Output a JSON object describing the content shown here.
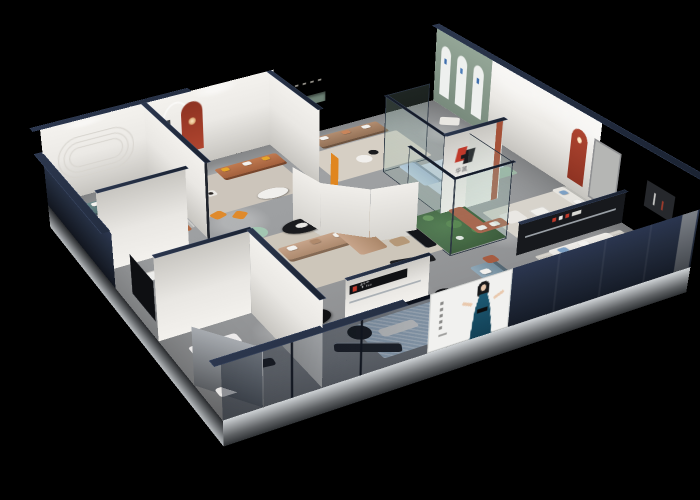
{
  "scene": {
    "description": "3D isometric cutaway render of a furniture showroom at night on a black background",
    "background": "#000000",
    "brand": {
      "logo_letter": "H",
      "logo_characters": "华凯",
      "logo_red": "#c0392b",
      "logo_black": "#1b1b1f"
    },
    "poster": {
      "background": "#f1f1ef",
      "subject": "woman in teal evening dress",
      "dress_color": "#175066",
      "hair_color": "#17181a"
    },
    "palette": {
      "floor": "#9a9c9e",
      "wall_interior": "#efedea",
      "wall_cap_navy": "#1f2838",
      "facade_navy": "#1b2230",
      "skirt_silver": "#cfd3d6",
      "accent_red_arch": "#a33b27",
      "accent_red_shelf": "#b23527",
      "accent_orange": "#e08a2c",
      "accent_teal_sofa": "#5d7d7f",
      "accent_caramel_sofa": "#b06a45",
      "accent_tan_sectional": "#bd9b82",
      "accent_light_blue_sofa": "#aec3da",
      "accent_sage_sofa": "#9cb6a4",
      "accent_blue_gray_sofa": "#8099a9",
      "accent_mint_ottoman": "#a3c6b2",
      "cream_sofa": "#e8e6e1",
      "green_arch_wall": "#8c9e8f",
      "garden_green": "#3a5c37",
      "glass_frame": "#2b3542"
    },
    "rooms": [
      {
        "name": "teal-sofa-lounge",
        "accent": "#5d7d7f"
      },
      {
        "name": "caramel-sofa-lounge-with-red-arch-and-statue",
        "accent": "#b06a45"
      },
      {
        "name": "tan-sofa-lounge-with-green-niche",
        "accent": "#a9836a"
      },
      {
        "name": "green-arch-display-wall",
        "accent": "#8c9e8f"
      },
      {
        "name": "blue-sofa-glass-room",
        "accent": "#aec3da"
      },
      {
        "name": "central-tan-sectional-with-curved-wall",
        "accent": "#bd9b82"
      },
      {
        "name": "glass-cactus-garden",
        "accent": "#3a5c37"
      },
      {
        "name": "cream-sofa-vignette-upper",
        "accent": "#e8e6e1"
      },
      {
        "name": "cream-sofa-vignette-lower",
        "accent": "#e8e6e1"
      },
      {
        "name": "front-dining-and-blue-gray-sofa-area",
        "accent": "#8099a9"
      }
    ]
  }
}
